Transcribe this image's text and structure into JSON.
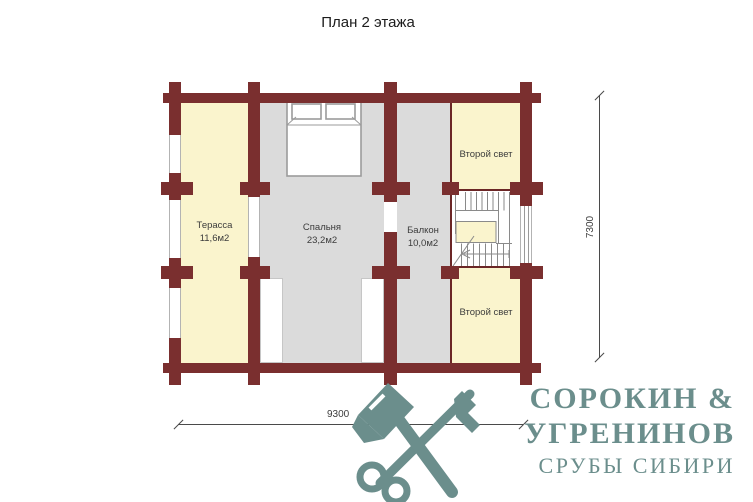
{
  "title": "План 2 этажа",
  "plan": {
    "rooms": {
      "terrace": {
        "label": "Терасса",
        "area": "11,6м2"
      },
      "bedroom": {
        "label": "Спальня",
        "area": "23,2м2"
      },
      "balcony": {
        "label": "Балкон",
        "area": "10,0м2"
      },
      "second_light_top": {
        "label": "Второй свет"
      },
      "second_light_bottom": {
        "label": "Второй свет"
      }
    },
    "dimensions": {
      "horizontal": "9300",
      "vertical": "7300"
    },
    "colors": {
      "wall": "#7A2F2F",
      "partition": "#6B2626",
      "room_cream": "#FAF4CD",
      "room_gray": "#DBDBDB",
      "dim": "#4a4a4a"
    }
  },
  "logo": {
    "name_line1": "СОРОКИН &",
    "name_line2": "УГРЕНИНОВ",
    "tagline": "СРУБЫ СИБИРИ",
    "color": "#6B8E8C",
    "icon": "crossed-axe-and-key"
  }
}
